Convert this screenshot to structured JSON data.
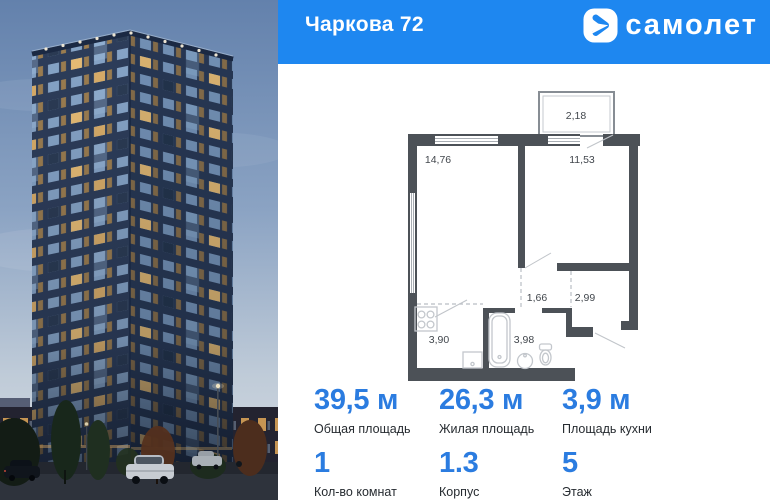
{
  "header": {
    "title": "Чаркова 72",
    "brand": "самолет"
  },
  "plan": {
    "rooms": [
      {
        "id": "balcony",
        "area": "2,18"
      },
      {
        "id": "living",
        "area": "14,76"
      },
      {
        "id": "bedroom",
        "area": "11,53"
      },
      {
        "id": "hallway",
        "area": "1,66"
      },
      {
        "id": "entry",
        "area": "2,99"
      },
      {
        "id": "kitchen",
        "area": "3,90"
      },
      {
        "id": "bathroom",
        "area": "3,98"
      }
    ]
  },
  "stats": [
    {
      "value": "39,5 м",
      "label": "Общая площадь"
    },
    {
      "value": "26,3 м",
      "label": "Жилая площадь"
    },
    {
      "value": "3,9 м",
      "label": "Площадь кухни"
    }
  ],
  "details": [
    {
      "value": "1",
      "label": "Кол-во комнат"
    },
    {
      "value": "1.3",
      "label": "Корпус"
    },
    {
      "value": "5",
      "label": "Этаж"
    }
  ],
  "colors": {
    "header_blue": "#1e87f0",
    "accent_blue": "#2b7ce0",
    "wall_gray": "#4c5157"
  }
}
